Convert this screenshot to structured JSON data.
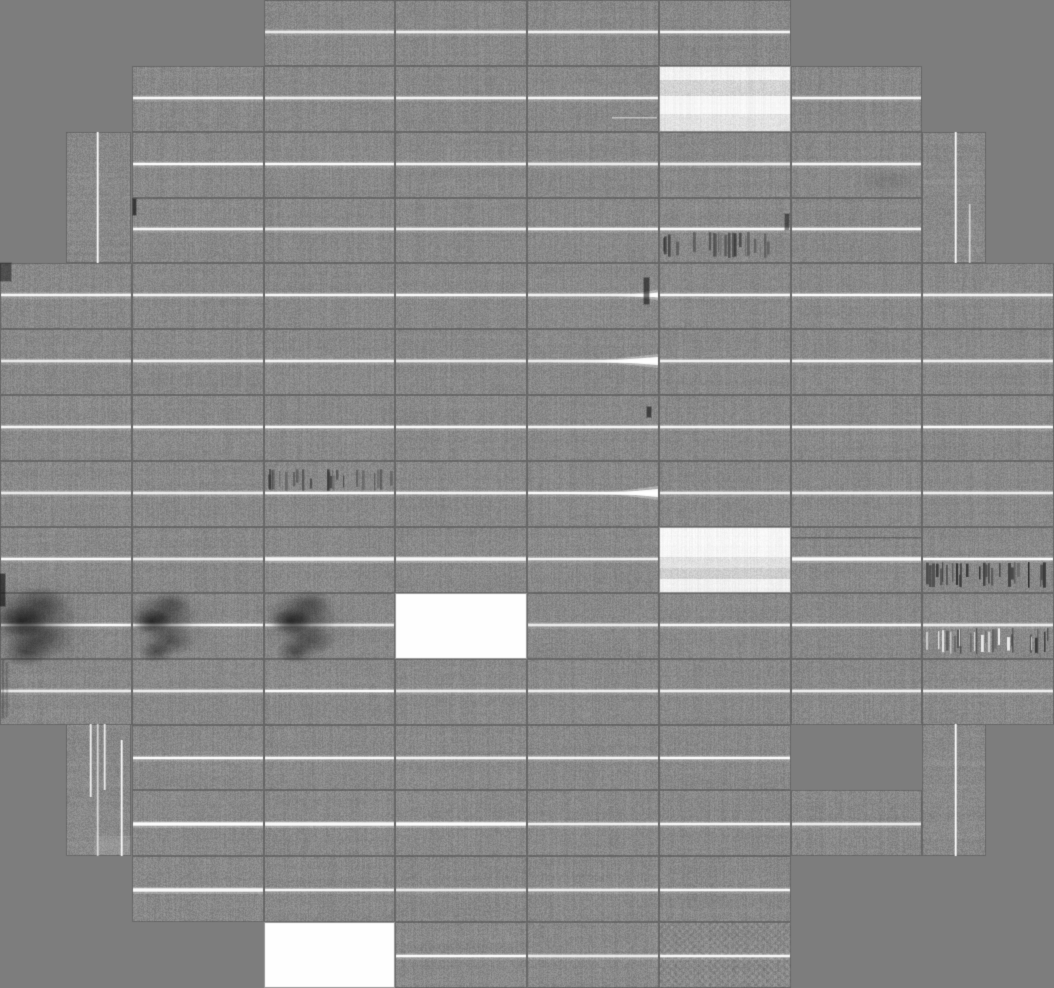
{
  "mosaic": {
    "width": 1054,
    "height": 988,
    "cols": 8,
    "rows_count": 15,
    "palette": {
      "background": "#7d7d7d",
      "tile_gray": "#898989",
      "tile_gap": "#6e6e6e",
      "bright_line": "#ffffff",
      "dead_tile": "#fefefe",
      "dark_artifact": "#141414"
    },
    "line_rel": 0.48,
    "line_rel_low": 0.51,
    "rows": [
      {
        "row": 0,
        "cols": [
          2,
          3,
          4,
          5
        ]
      },
      {
        "row": 1,
        "cols": [
          1,
          2,
          3,
          4,
          5,
          6
        ]
      },
      {
        "row": 2,
        "cols": [
          1,
          2,
          3,
          4,
          5,
          6
        ]
      },
      {
        "row": 3,
        "cols": [
          1,
          2,
          3,
          4,
          5,
          6
        ]
      },
      {
        "row": 4,
        "cols": [
          0,
          1,
          2,
          3,
          4,
          5,
          6,
          7
        ]
      },
      {
        "row": 5,
        "cols": [
          0,
          1,
          2,
          3,
          4,
          5,
          6,
          7
        ]
      },
      {
        "row": 6,
        "cols": [
          0,
          1,
          2,
          3,
          4,
          5,
          6,
          7
        ]
      },
      {
        "row": 7,
        "cols": [
          0,
          1,
          2,
          3,
          4,
          5,
          6,
          7
        ]
      },
      {
        "row": 8,
        "cols": [
          0,
          1,
          2,
          3,
          4,
          5,
          6,
          7
        ]
      },
      {
        "row": 9,
        "cols": [
          0,
          1,
          2,
          3,
          4,
          5,
          6,
          7
        ]
      },
      {
        "row": 10,
        "cols": [
          0,
          1,
          2,
          3,
          4,
          5,
          6,
          7
        ]
      },
      {
        "row": 11,
        "cols": [
          1,
          2,
          3,
          4,
          5
        ]
      },
      {
        "row": 12,
        "cols": [
          1,
          2,
          3,
          4,
          5,
          6
        ]
      },
      {
        "row": 13,
        "cols": [
          1,
          2,
          3,
          4,
          5
        ]
      },
      {
        "row": 14,
        "cols": [
          2,
          3,
          4,
          5
        ]
      }
    ],
    "tall_tiles": [
      {
        "x": 66,
        "y": 132,
        "w": 65,
        "h": 131,
        "lines": [
          {
            "rel": 0.48,
            "from": 0,
            "to": 1,
            "bright": 0.95
          }
        ]
      },
      {
        "x": 922,
        "y": 132,
        "w": 64,
        "h": 131,
        "lines": [
          {
            "rel": 0.52,
            "from": 0,
            "to": 1,
            "bright": 0.95
          },
          {
            "rel": 0.73,
            "from": 0.55,
            "to": 1,
            "bright": 0.55
          }
        ]
      },
      {
        "x": 66,
        "y": 724,
        "w": 65,
        "h": 132,
        "lines": [
          {
            "rel": 0.37,
            "from": 0,
            "to": 0.55,
            "bright": 0.85
          },
          {
            "rel": 0.48,
            "from": 0,
            "to": 1,
            "bright": 0.6
          },
          {
            "rel": 0.58,
            "from": 0,
            "to": 0.5,
            "bright": 0.8
          },
          {
            "rel": 0.85,
            "from": 0.12,
            "to": 1,
            "bright": 0.95
          }
        ],
        "bright_patch": [
          94,
          836,
          37,
          19
        ]
      },
      {
        "x": 922,
        "y": 724,
        "w": 64,
        "h": 132,
        "lines": [
          {
            "rel": 0.52,
            "from": 0,
            "to": 1,
            "bright": 1
          }
        ]
      }
    ],
    "white_tiles": [
      [
        3,
        9
      ],
      [
        2,
        14
      ]
    ],
    "washed_tiles": {
      "5,1": [
        [
          0,
          0.2,
          242,
          6
        ],
        [
          0.2,
          0.45,
          211,
          12
        ],
        [
          0.45,
          0.72,
          246,
          3
        ],
        [
          0.72,
          1,
          226,
          9
        ]
      ],
      "5,8": [
        [
          0,
          0.45,
          246,
          4
        ],
        [
          0.45,
          0.62,
          224,
          9
        ],
        [
          0.62,
          0.78,
          206,
          11
        ],
        [
          0.78,
          1,
          241,
          5
        ]
      ]
    },
    "crosshatch_tiles": [
      [
        5,
        14
      ]
    ],
    "glow_boost": [
      [
        2,
        8
      ],
      [
        3,
        8
      ],
      [
        6,
        8
      ],
      [
        1,
        12
      ],
      [
        2,
        12
      ],
      [
        3,
        12
      ],
      [
        1,
        13
      ]
    ],
    "barcodes": [
      {
        "col": 2,
        "row": 7,
        "side": "above",
        "mix": "dark",
        "strength": 1
      },
      {
        "col": 5,
        "row": 3,
        "side": "below",
        "mix": "dark",
        "strength": 1
      },
      {
        "col": 7,
        "row": 8,
        "side": "below",
        "mix": "dark",
        "strength": 1.4
      },
      {
        "col": 7,
        "row": 9,
        "side": "below",
        "mix": "mixed",
        "strength": 1
      }
    ],
    "flares": [
      {
        "col": 4,
        "row": 4,
        "len": 22,
        "half": 2.5
      },
      {
        "col": 4,
        "row": 5,
        "len": 55,
        "half": 4
      },
      {
        "col": 4,
        "row": 7,
        "len": 45,
        "half": 4
      }
    ],
    "blobs": [
      {
        "row": 9,
        "cx": 38,
        "scale": 1.25
      },
      {
        "row": 9,
        "cx": 168,
        "scale": 0.95
      },
      {
        "row": 9,
        "cx": 307,
        "scale": 1.0
      }
    ],
    "dark_marks": [
      [
        644,
        278,
        5,
        26,
        0.45
      ],
      [
        647,
        407,
        4,
        10,
        0.5
      ],
      [
        133,
        199,
        3,
        16,
        0.55
      ],
      [
        785,
        214,
        4,
        16,
        0.4
      ],
      [
        0,
        574,
        5,
        32,
        0.5
      ],
      [
        0,
        263,
        11,
        18,
        0.35
      ],
      [
        2,
        660,
        2,
        58,
        0.18
      ],
      [
        6,
        662,
        2,
        55,
        0.13
      ]
    ],
    "faint_lines": [
      {
        "x0": 612,
        "x1": 657,
        "y": 117,
        "color": "white",
        "alpha": 0.5
      },
      {
        "x0": 791,
        "x1": 921,
        "y": 537,
        "color": "black",
        "alpha": 0.3
      }
    ],
    "soft_shadows": [
      [
        888,
        181,
        36,
        13,
        0.12
      ]
    ]
  }
}
